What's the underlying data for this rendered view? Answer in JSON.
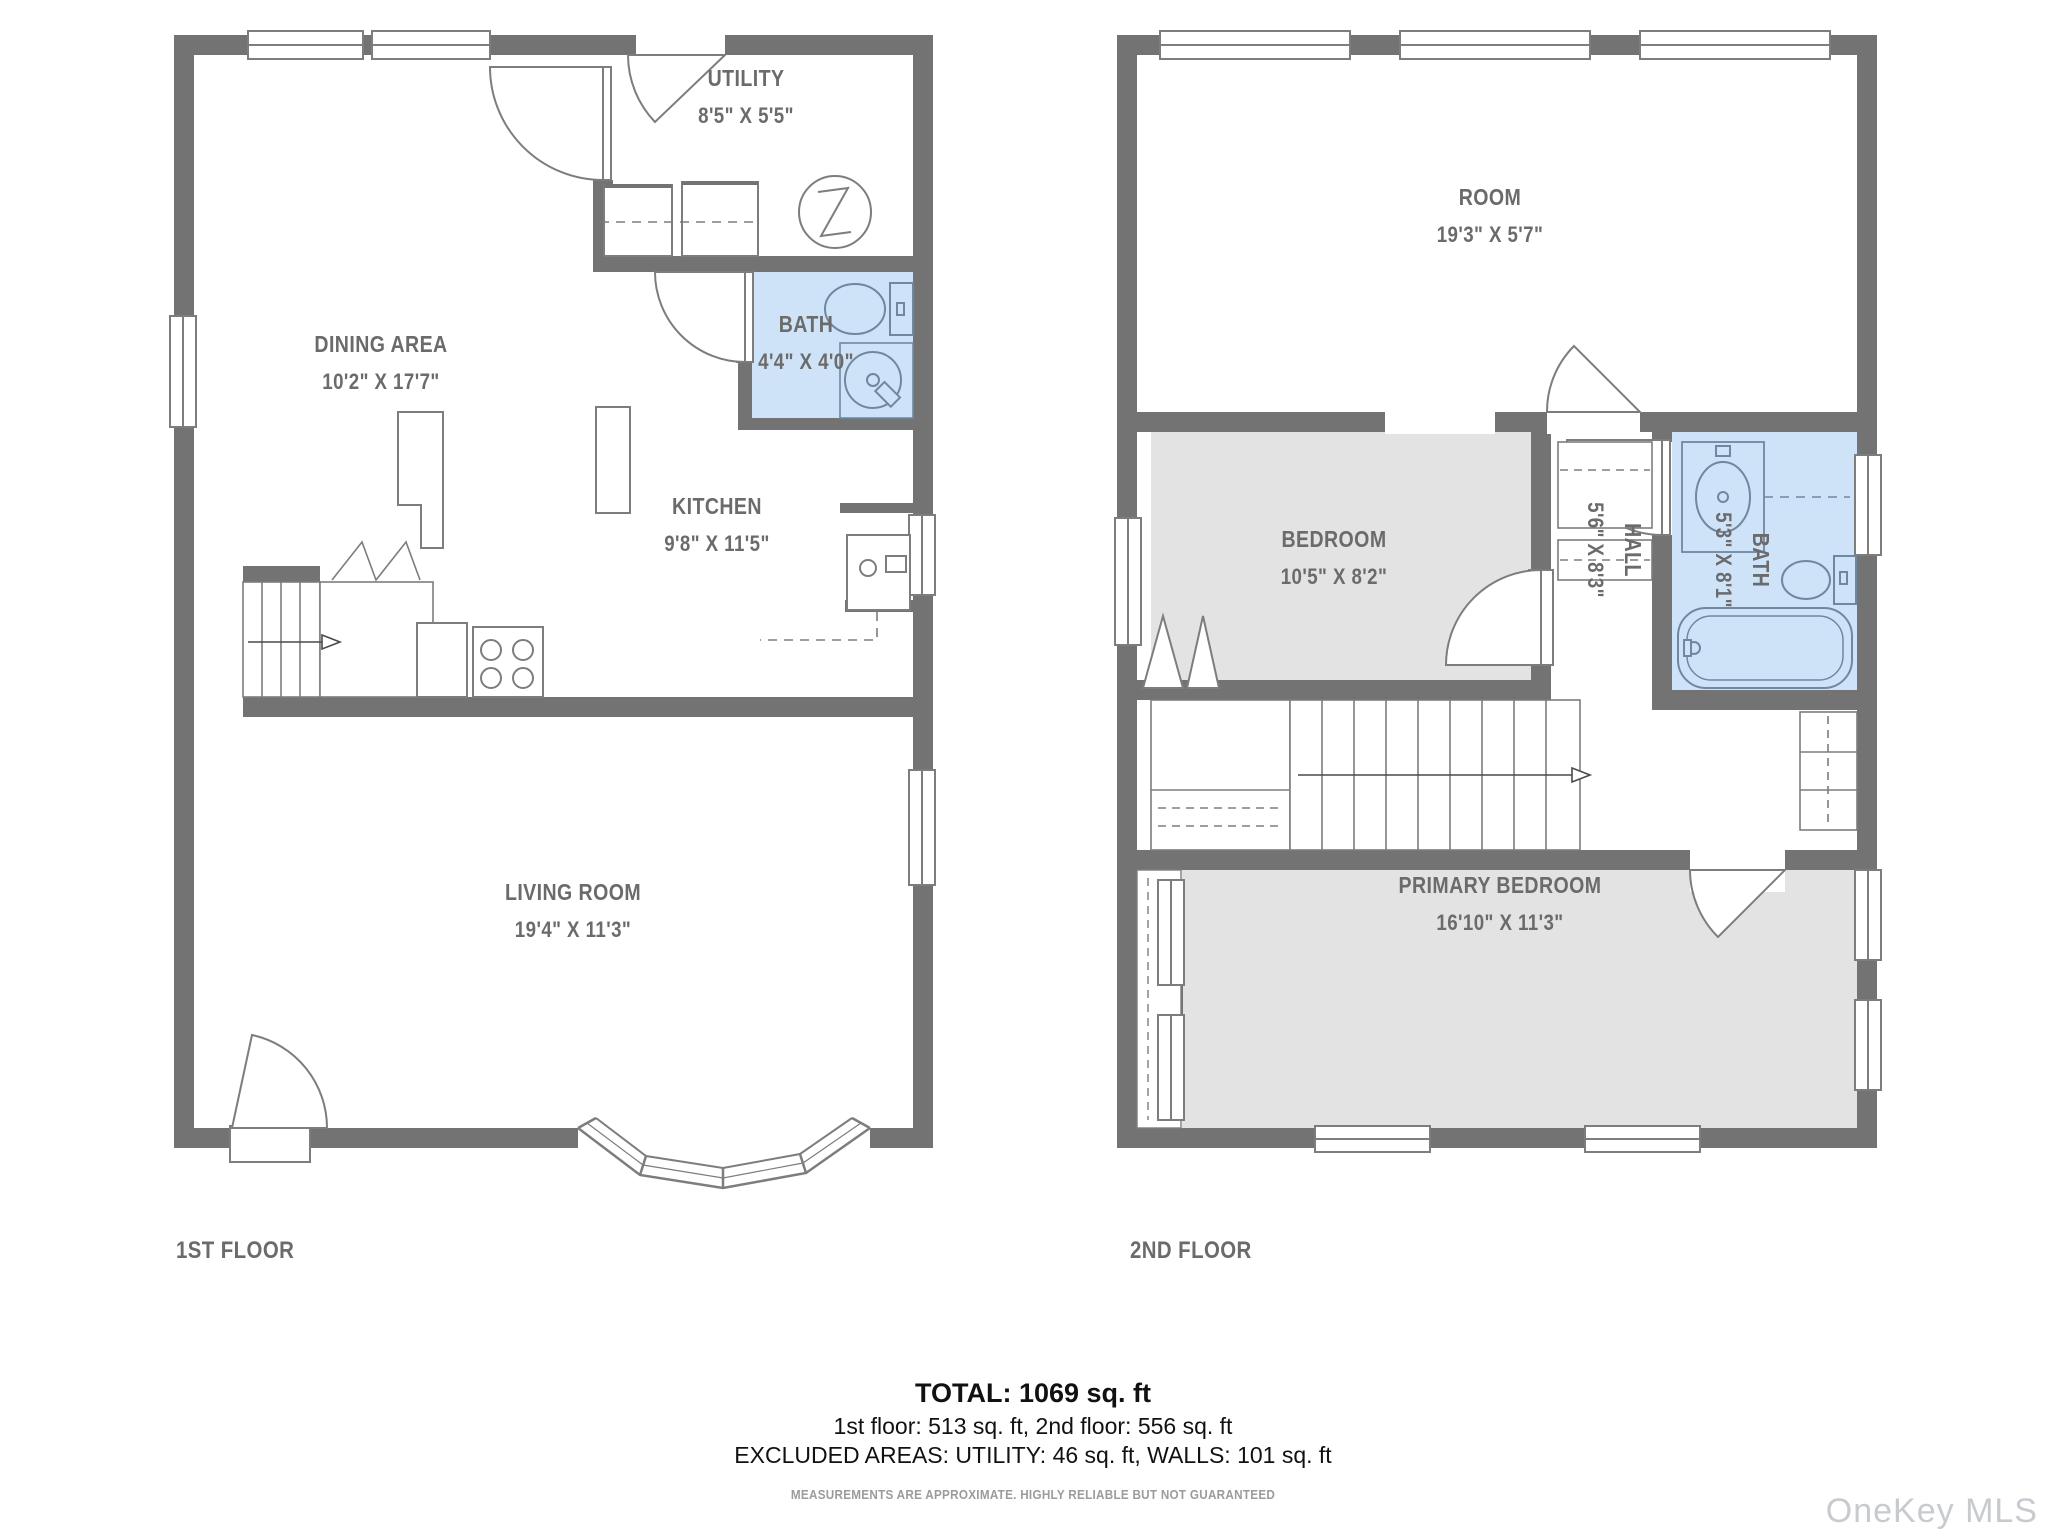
{
  "colors": {
    "wall": "#737373",
    "bath_fill": "#cfe3f8",
    "room_fill": "#e3e3e3",
    "fixture_stroke": "#7d7d7d",
    "label_text": "#6b6b6b",
    "watermark_text": "#c7cbd0"
  },
  "floors": [
    {
      "name": "1ST FLOOR",
      "rooms": [
        {
          "name": "UTILITY",
          "dims": "8'5\" X 5'5\""
        },
        {
          "name": "DINING AREA",
          "dims": "10'2\" X 17'7\""
        },
        {
          "name": "BATH",
          "dims": "4'4\" X 4'0\""
        },
        {
          "name": "KITCHEN",
          "dims": "9'8\" X 11'5\""
        },
        {
          "name": "LIVING ROOM",
          "dims": "19'4\" X 11'3\""
        }
      ]
    },
    {
      "name": "2ND FLOOR",
      "rooms": [
        {
          "name": "ROOM",
          "dims": "19'3\" X 5'7\""
        },
        {
          "name": "BEDROOM",
          "dims": "10'5\" X 8'2\""
        },
        {
          "name": "BATH",
          "dims": "5'3\" X 8'1\""
        },
        {
          "name": "HALL",
          "dims": "5'6\" X 8'3\""
        },
        {
          "name": "PRIMARY BEDROOM",
          "dims": "16'10\" X 11'3\""
        }
      ]
    }
  ],
  "summary": {
    "total": "TOTAL: 1069 sq. ft",
    "floors_line": "1st floor: 513 sq. ft, 2nd floor: 556 sq. ft",
    "excluded_line": "EXCLUDED AREAS: UTILITY: 46 sq. ft, WALLS: 101 sq. ft"
  },
  "disclaimer": "MEASUREMENTS ARE APPROXIMATE. HIGHLY RELIABLE BUT NOT GUARANTEED",
  "watermark": "OneKey MLS"
}
